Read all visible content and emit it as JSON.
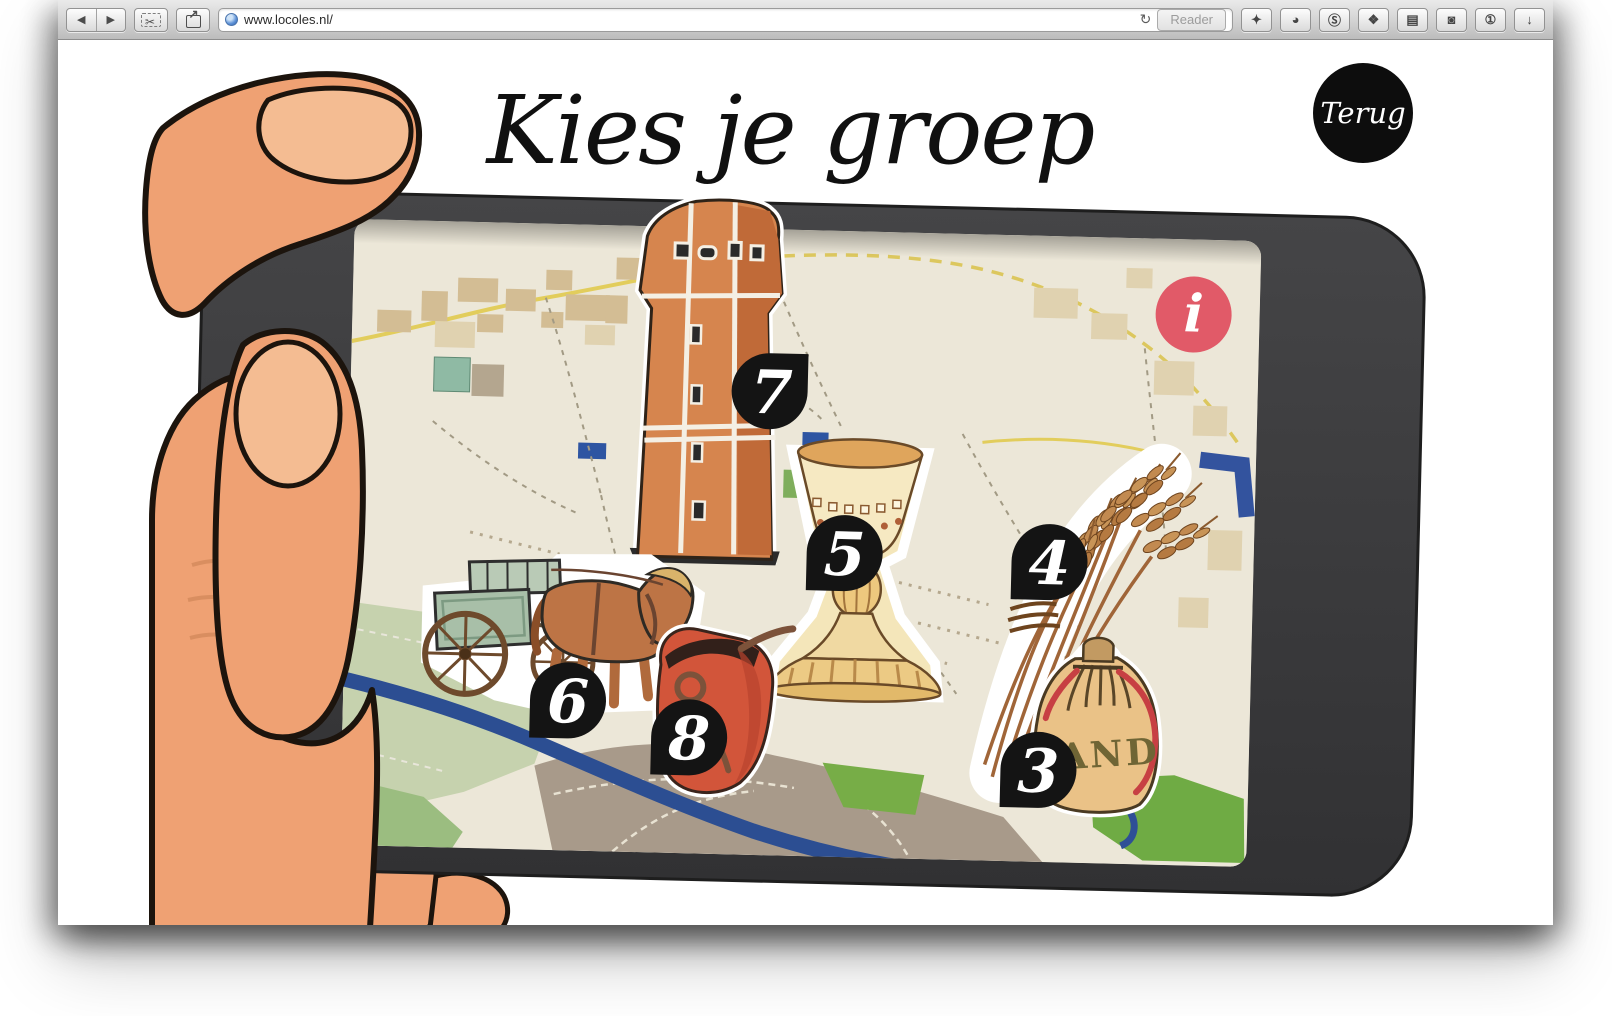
{
  "browser": {
    "url": "www.locoles.nl/",
    "reader_label": "Reader",
    "back_glyph": "◀",
    "forward_glyph": "▶",
    "snip_glyph": "✂",
    "share_glyph": "↗",
    "refresh_glyph": "↻",
    "extensions": [
      {
        "name": "dart",
        "glyph": "✦"
      },
      {
        "name": "record-circle",
        "glyph": "◕"
      },
      {
        "name": "skype",
        "glyph": "Ⓢ"
      },
      {
        "name": "web-clipper",
        "glyph": "❖"
      },
      {
        "name": "notebook",
        "glyph": "▤"
      },
      {
        "name": "shield",
        "glyph": "◙"
      },
      {
        "name": "info-circle",
        "glyph": "①"
      },
      {
        "name": "downloads",
        "glyph": "↓"
      }
    ]
  },
  "page": {
    "title": "Kies je groep",
    "back_button_label": "Terug",
    "info_button_label": "i"
  },
  "map": {
    "markers": [
      {
        "number": "7",
        "item": "water-tower"
      },
      {
        "number": "5",
        "item": "chalice"
      },
      {
        "number": "4",
        "item": "wheat-sheaf"
      },
      {
        "number": "6",
        "item": "horse-and-cart"
      },
      {
        "number": "8",
        "item": "leather-pouch"
      },
      {
        "number": "3",
        "item": "sand-bag"
      }
    ],
    "sand_bag_text": "ZAND"
  },
  "colors": {
    "marker_black": "#141414",
    "info_pink": "#e15a68",
    "phone_body": "#3a3a3c",
    "map_cream": "#ece7d8",
    "skin": "#efa173"
  }
}
